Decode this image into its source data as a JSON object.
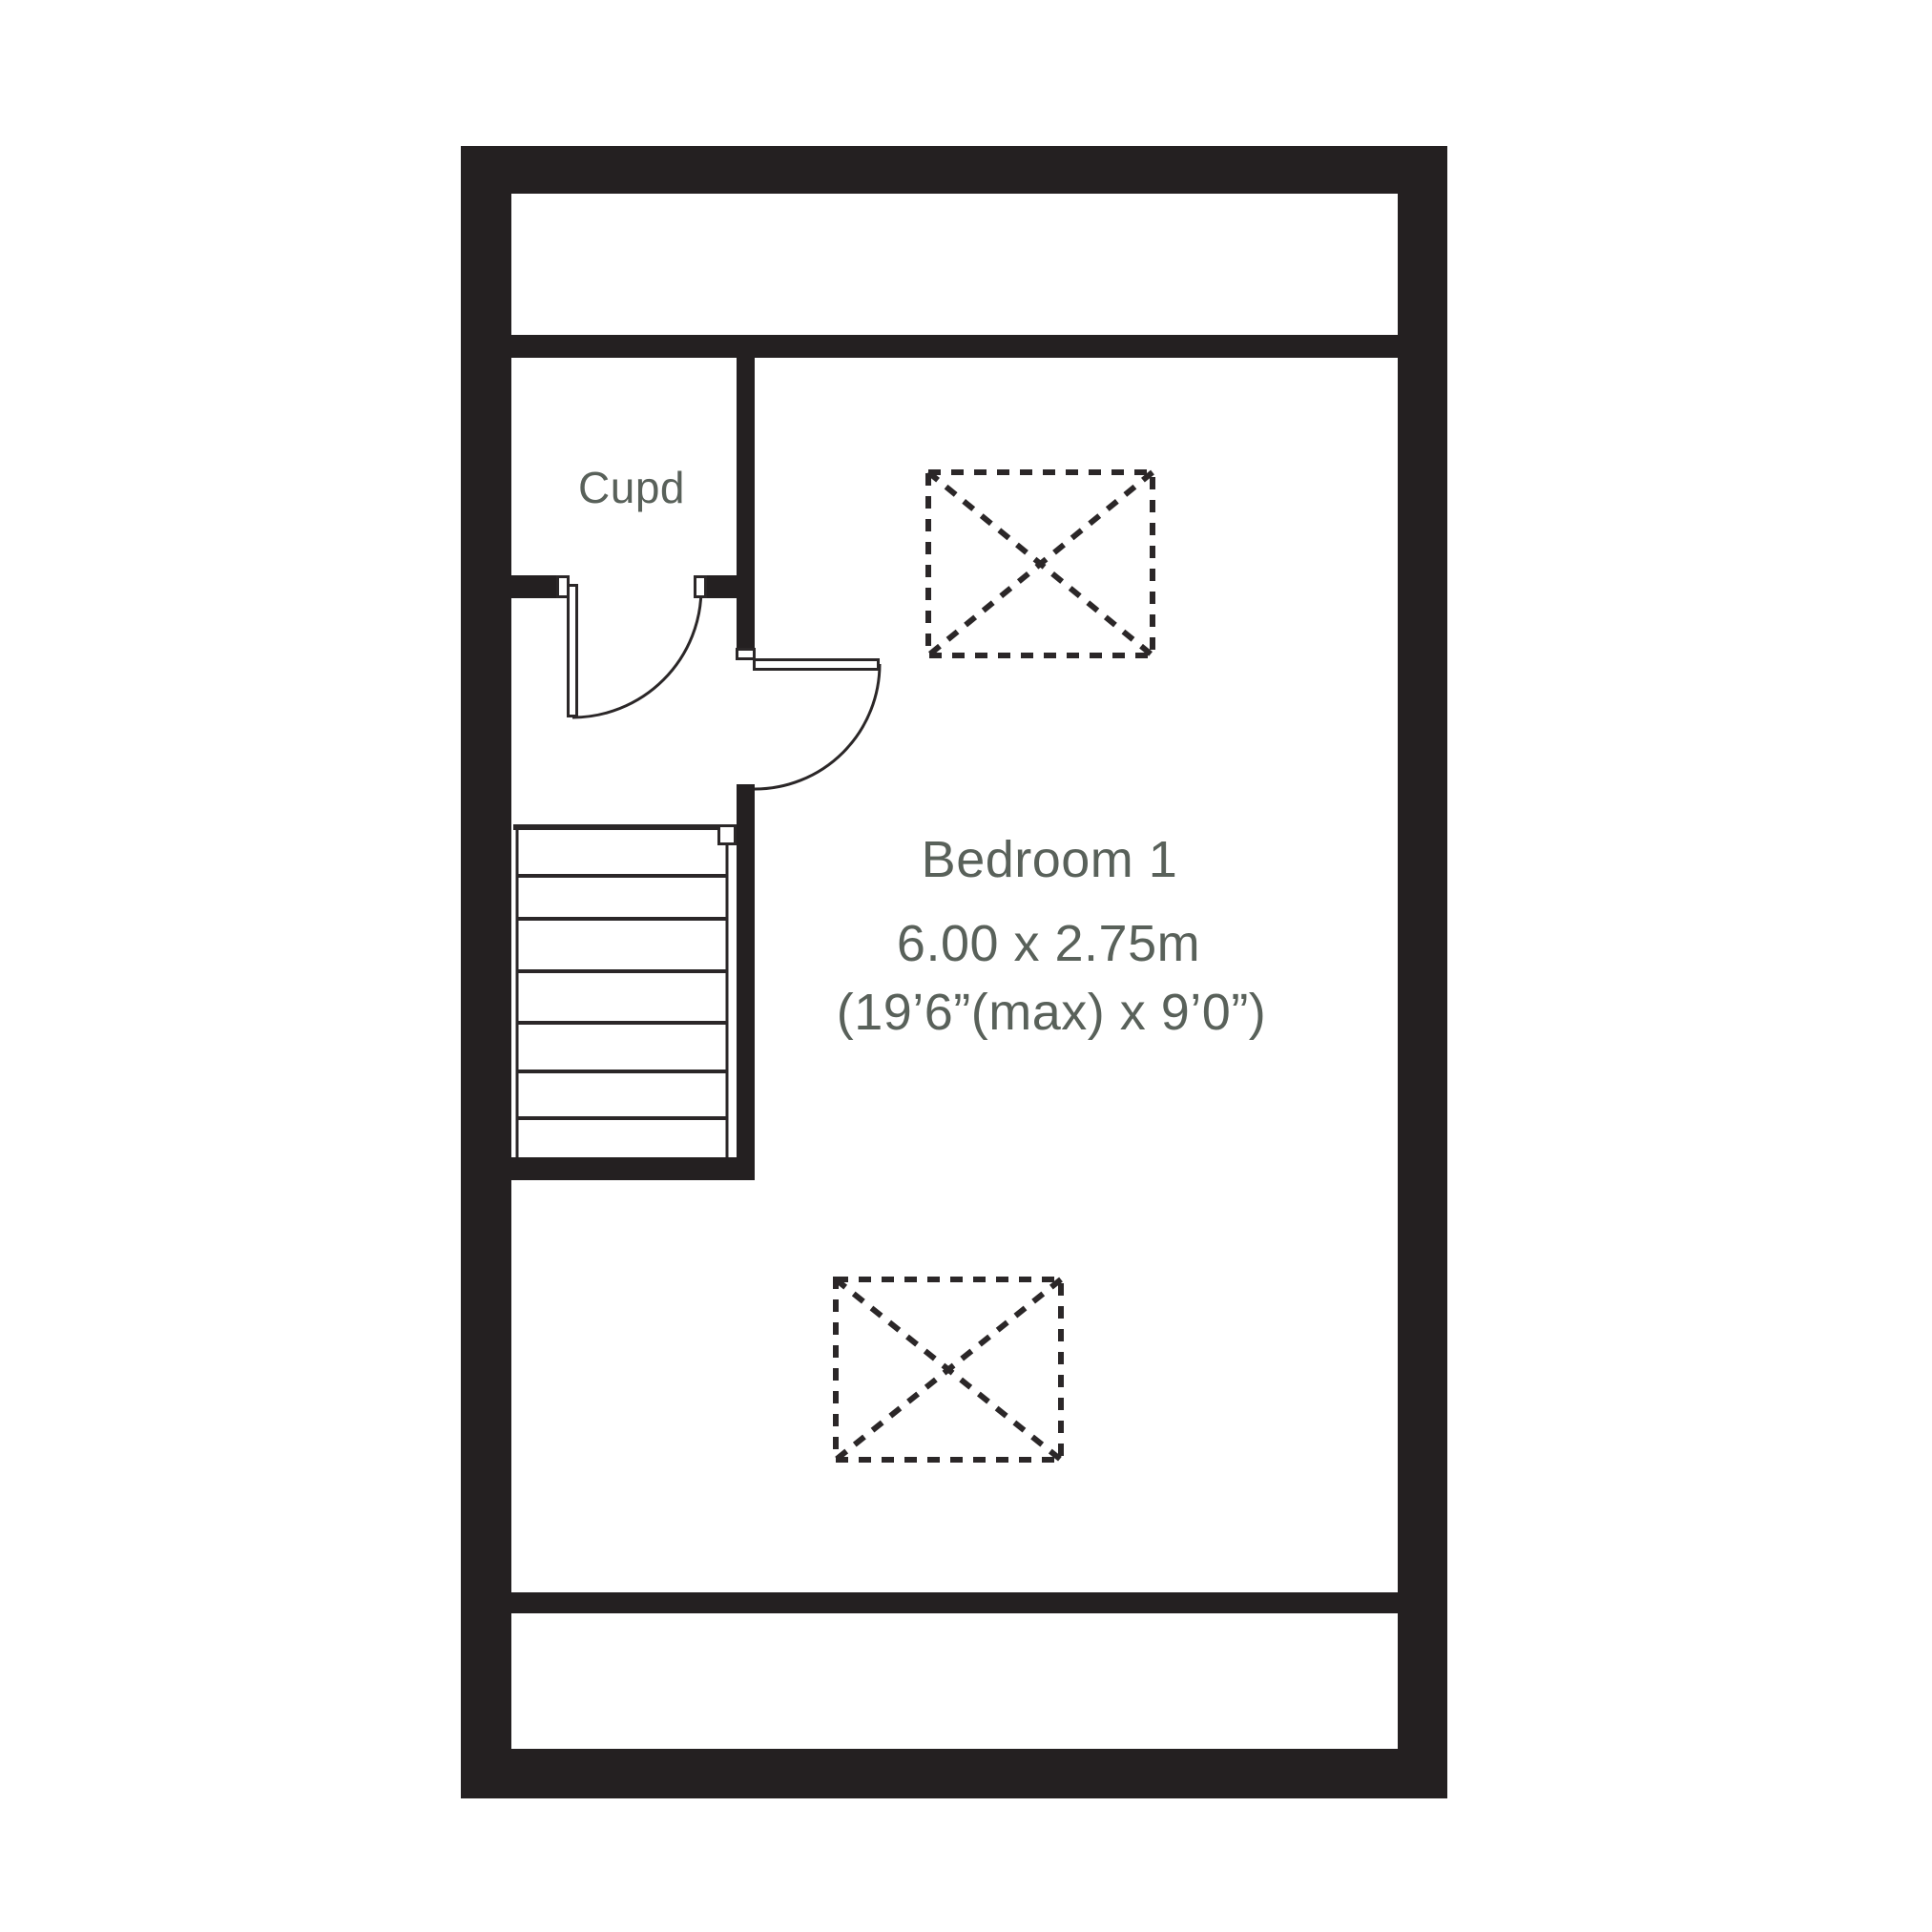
{
  "rooms": {
    "cupboard": {
      "label": "Cupd"
    },
    "bedroom": {
      "label": "Bedroom 1",
      "size_metric": "6.00 x 2.75m",
      "size_imperial": "(19’6”(max) x 9’0”)"
    }
  },
  "symbols": {
    "roof_window_count": 2,
    "stair_tread_count": 7,
    "door_count": 2
  },
  "colors": {
    "wall": "#242021",
    "line": "#2b2728",
    "label_text": "#59615a",
    "background": "#ffffff"
  }
}
